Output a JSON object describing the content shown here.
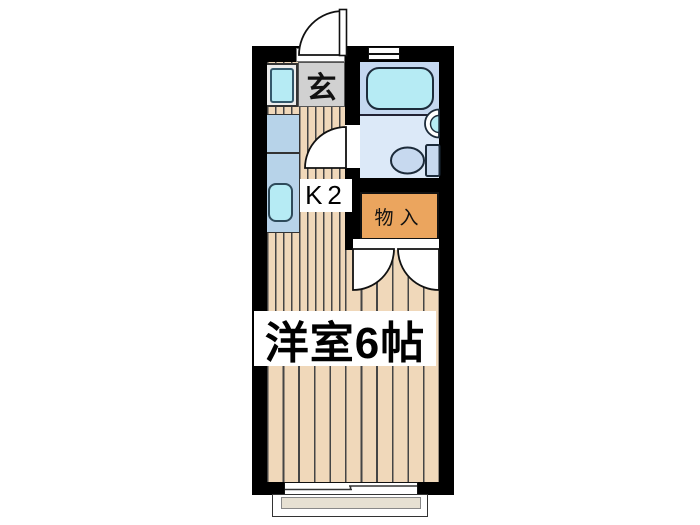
{
  "floorplan": {
    "type": "apartment-floor-plan",
    "rooms": {
      "entrance_label": "玄",
      "kitchen_label": "K2",
      "closet_label": "物入",
      "main_room_label": "洋室6帖"
    },
    "fixtures": {
      "bathroom": [
        "bathtub",
        "toilet",
        "wash-basin",
        "window"
      ],
      "kitchen": [
        "washing-machine",
        "counter",
        "sink"
      ],
      "exterior": [
        "balcony",
        "sliding-window",
        "entrance-door"
      ]
    },
    "colors": {
      "wall": "#000000",
      "wood_floor": "#f0d8ba",
      "wood_stripe": "#454545",
      "entrance_floor": "#d1d1d1",
      "closet_fill": "#eba55e",
      "counter_fill": "#b7d3e9",
      "fixture_cyan": "#b6ebf4",
      "bath_zone_fill": "#c5d8f0",
      "bathroom_floor": "#dce9f8",
      "toilet_fill": "#c7d9ef",
      "balcony_fill": "#e6e0d2"
    }
  }
}
